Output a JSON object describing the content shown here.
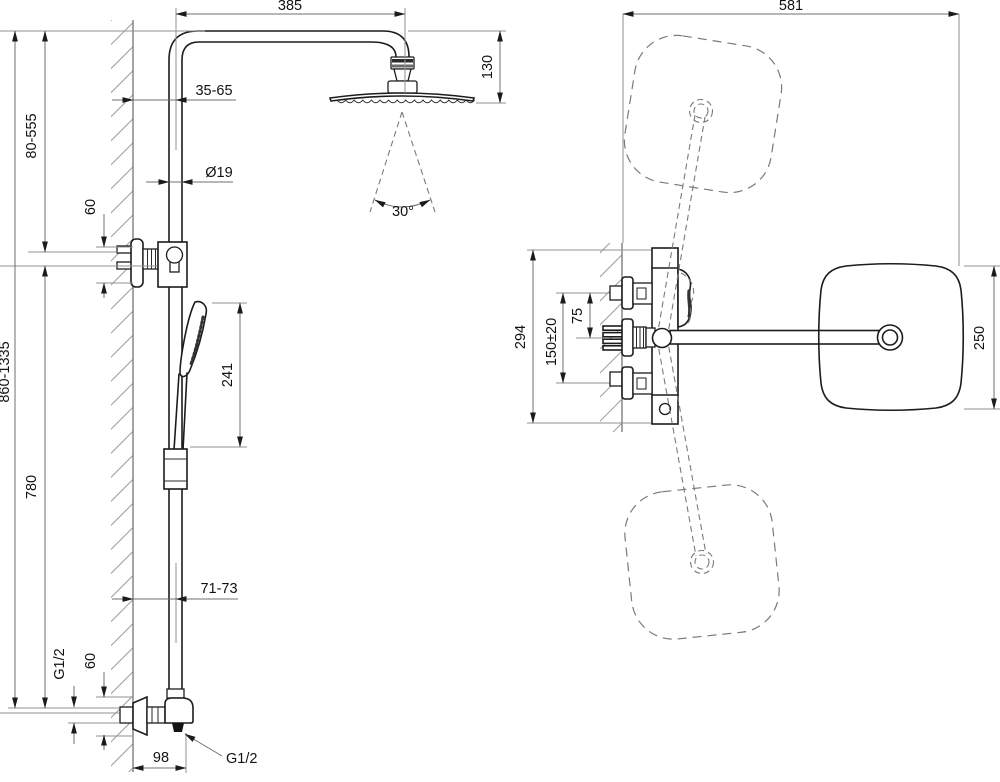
{
  "front": {
    "arm_reach": "385",
    "head_drop": "130",
    "wall_clearance_top": "35-65",
    "pipe_diameter": "Ø19",
    "bracket_height_top": "60",
    "upper_adjust_range": "80-555",
    "column_length": "780",
    "overall_height": "860-1335",
    "hand_shower_length": "241",
    "spray_angle": "30°",
    "wall_clearance_bottom": "71-73",
    "inlet_thread": "G1/2",
    "bracket_height_bottom": "60",
    "outlet_offset": "98",
    "outlet_thread": "G1/2"
  },
  "top": {
    "overall_width": "581",
    "overall_depth": "294",
    "inlet_spacing": "150±20",
    "inlet_offset": "75",
    "head_width": "250"
  }
}
